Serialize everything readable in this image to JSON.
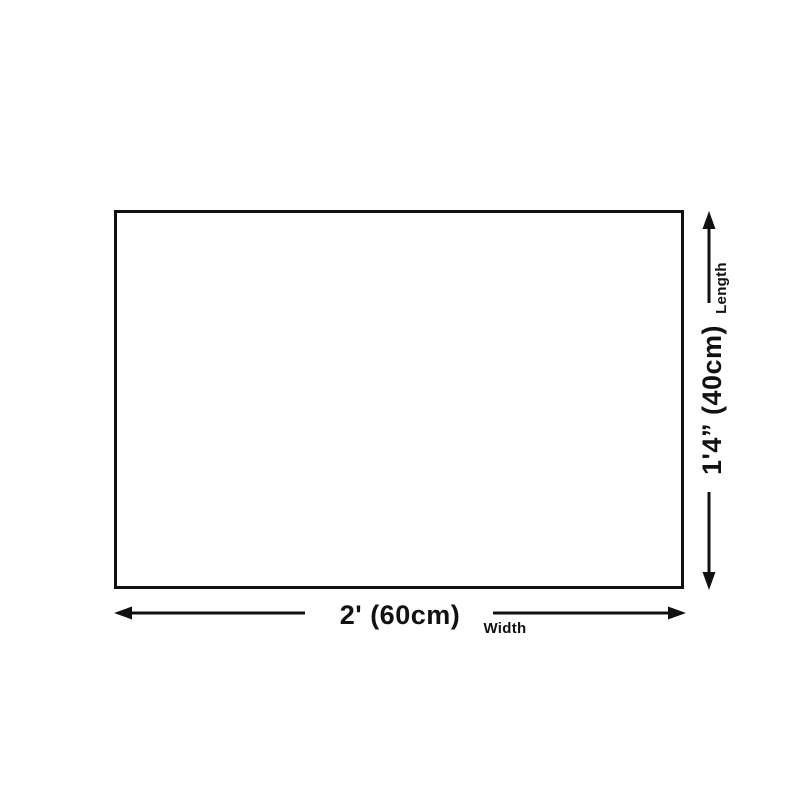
{
  "diagram": {
    "title_hint": "product-dimension-diagram",
    "length": {
      "label": "Length",
      "value": "1'4” (40cm)"
    },
    "width": {
      "label": "Width",
      "value": "2' (60cm)"
    }
  },
  "colors": {
    "ink": "#111111",
    "background": "#ffffff"
  }
}
